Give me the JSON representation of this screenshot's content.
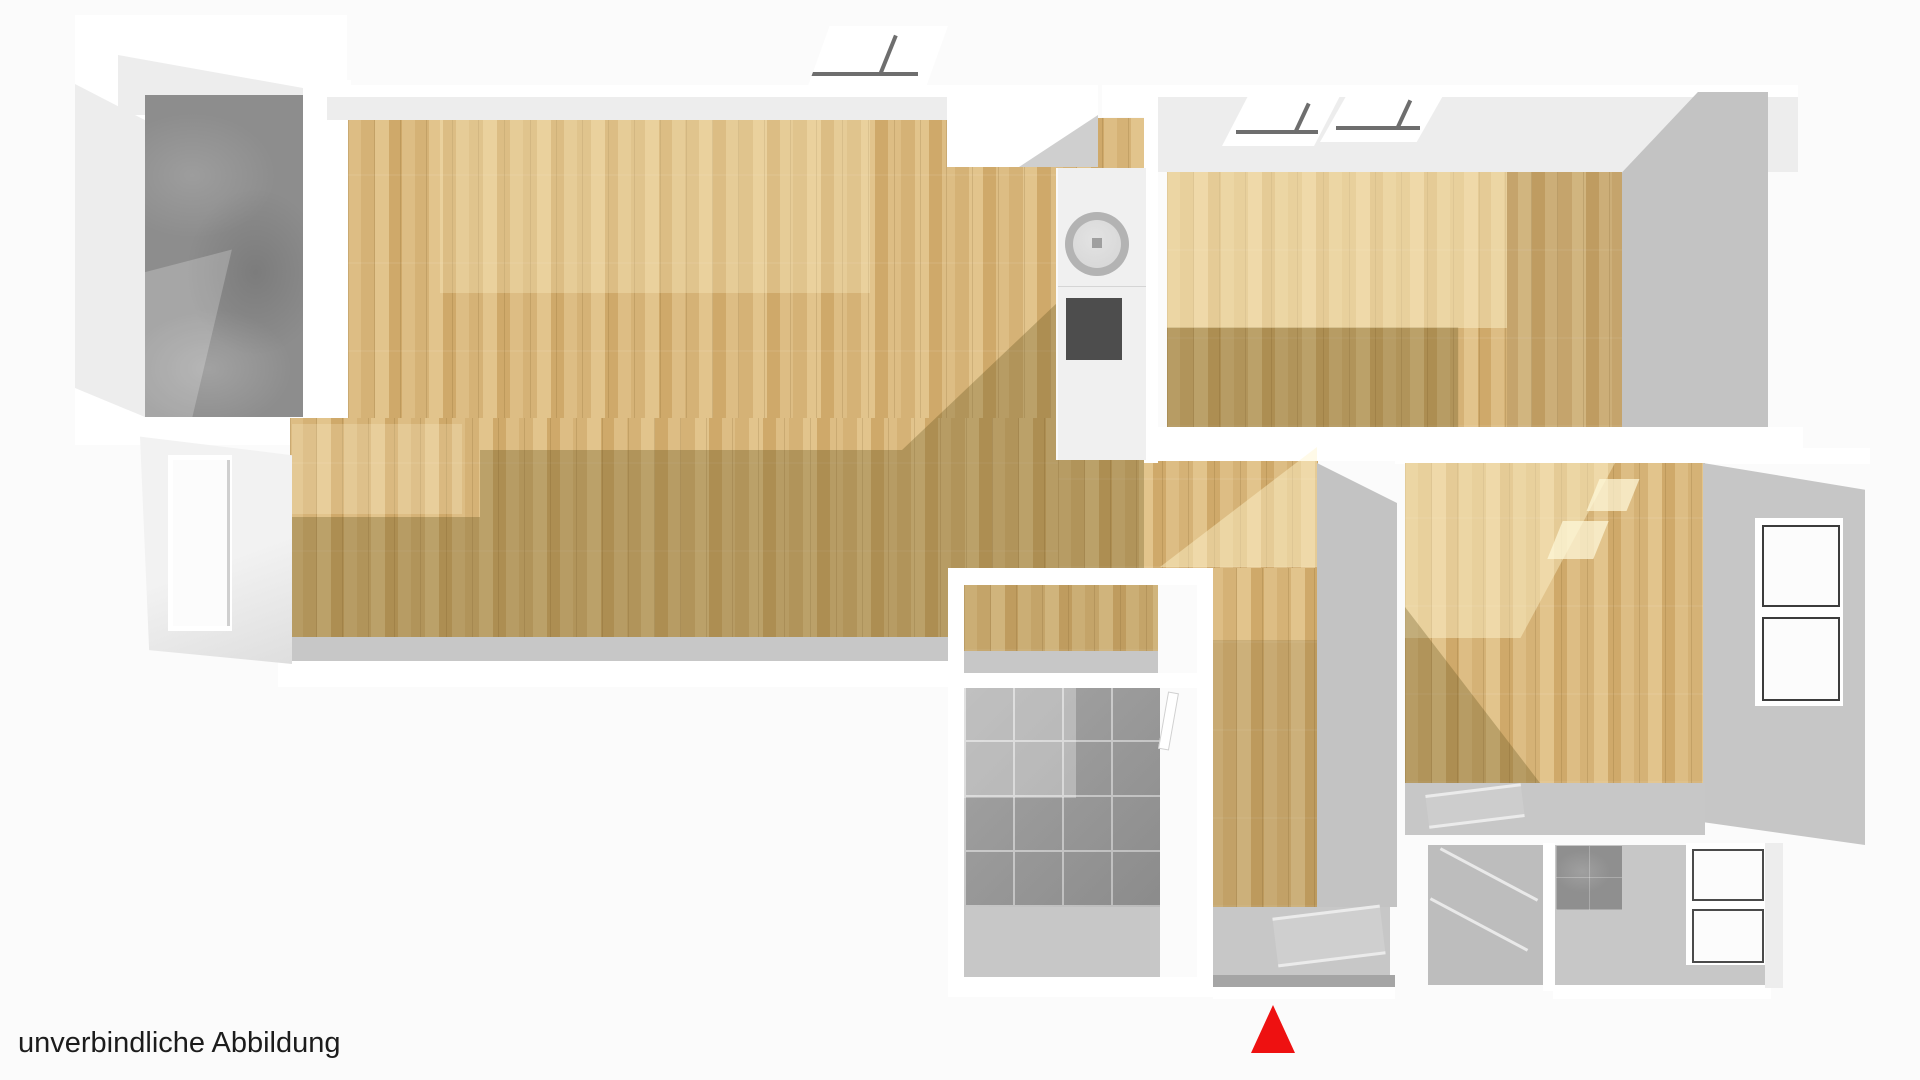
{
  "caption": {
    "text": "unverbindliche Abbildung"
  },
  "marker": {
    "icon": "entrance-marker-icon",
    "shape": "triangle-up",
    "color": "#ee1111"
  },
  "colors": {
    "bg": "#fbfbfb",
    "wall": "#ffffff",
    "wallface": "#ededed",
    "wallface_dark": "#d9d9d9",
    "wallgray": "#c3c3c3",
    "wood_base": "#d9b97e",
    "wood_a": "#ddbd84",
    "wood_b": "#d5b276",
    "wood_c": "#e2c48c",
    "wood_d": "#cfa96a",
    "wood_shadow": "rgba(96,80,28,0.30)",
    "wood_sun": "rgba(255,243,205,0.45)",
    "stone": "#8d8d8d",
    "stone_light": "rgba(255,255,255,0.22)",
    "tile": "#9b9b9b",
    "tile_light": "rgba(255,255,255,0.30)",
    "grout": "#cfcfcf",
    "concrete": "#c7c7c7",
    "concrete_dark": "#a5a5a5",
    "dark_tile": "#8f8f8f",
    "cooktop": "#4d4d4d",
    "sink_ring": "#b3b3b3",
    "sink_bowl": "#d9d9d9",
    "glass_gray_a": "#969696",
    "glass_gray_b": "#b0b0b0",
    "glass_white": "#fcfcfc",
    "marker_red": "#ee1111",
    "caption_color": "#1c1c1c"
  }
}
